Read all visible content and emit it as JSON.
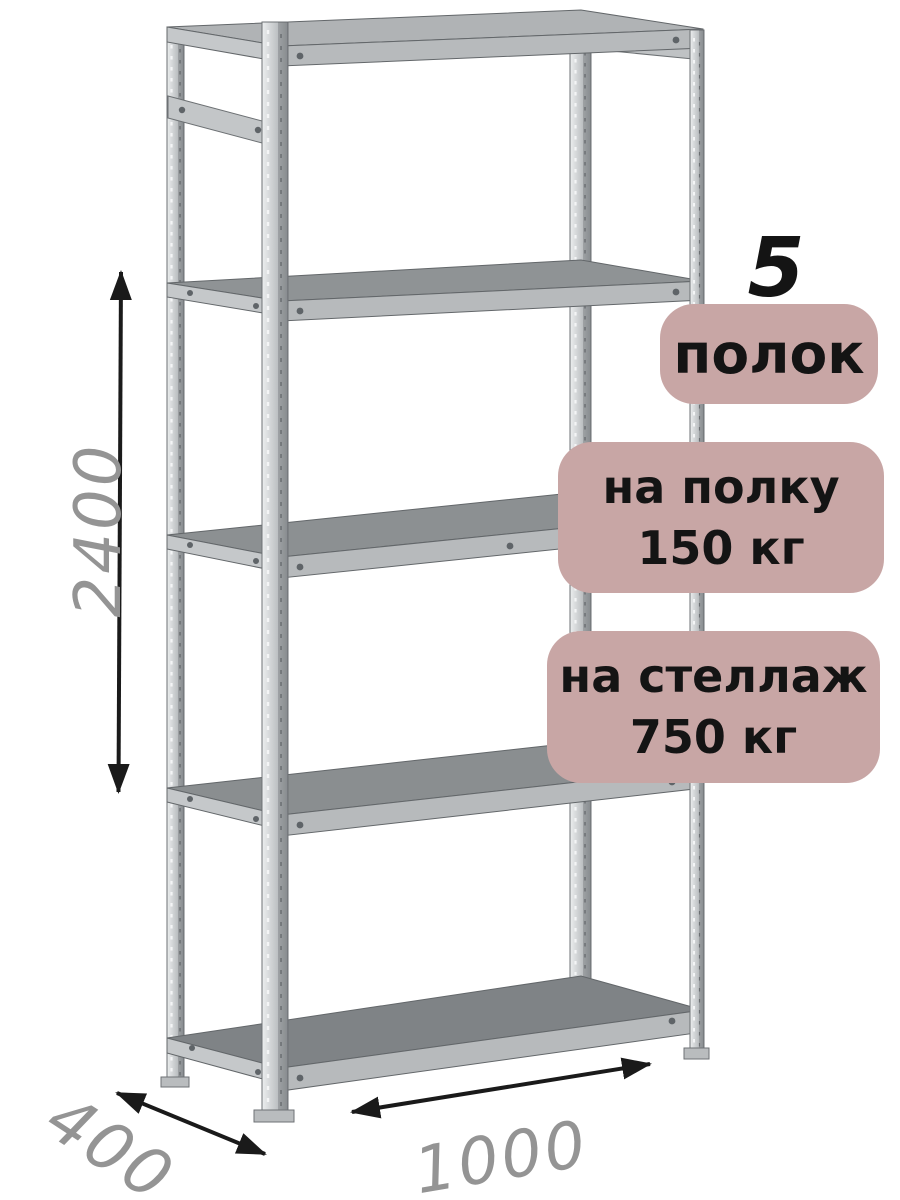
{
  "product": {
    "type": "metal-shelving-rack-render",
    "shelf_count": 5
  },
  "annotations": {
    "shelf_count_number": "5",
    "shelf_count_label": "полок",
    "shelf_load": {
      "line1": "на полку",
      "line2": "150 кг"
    },
    "rack_load": {
      "line1": "на стеллаж",
      "line2": "750 кг"
    }
  },
  "dimensions": {
    "height": "2400",
    "depth": "400",
    "width": "1000"
  },
  "colors": {
    "badge_background": "#c8a6a5",
    "badge_text": "#141414",
    "dimension_text": "#949494",
    "arrow": "#1a1a1a",
    "metal_light": "#e9ebec",
    "metal_dark": "#9da1a4",
    "shelf_surface": "#8a8e90"
  }
}
